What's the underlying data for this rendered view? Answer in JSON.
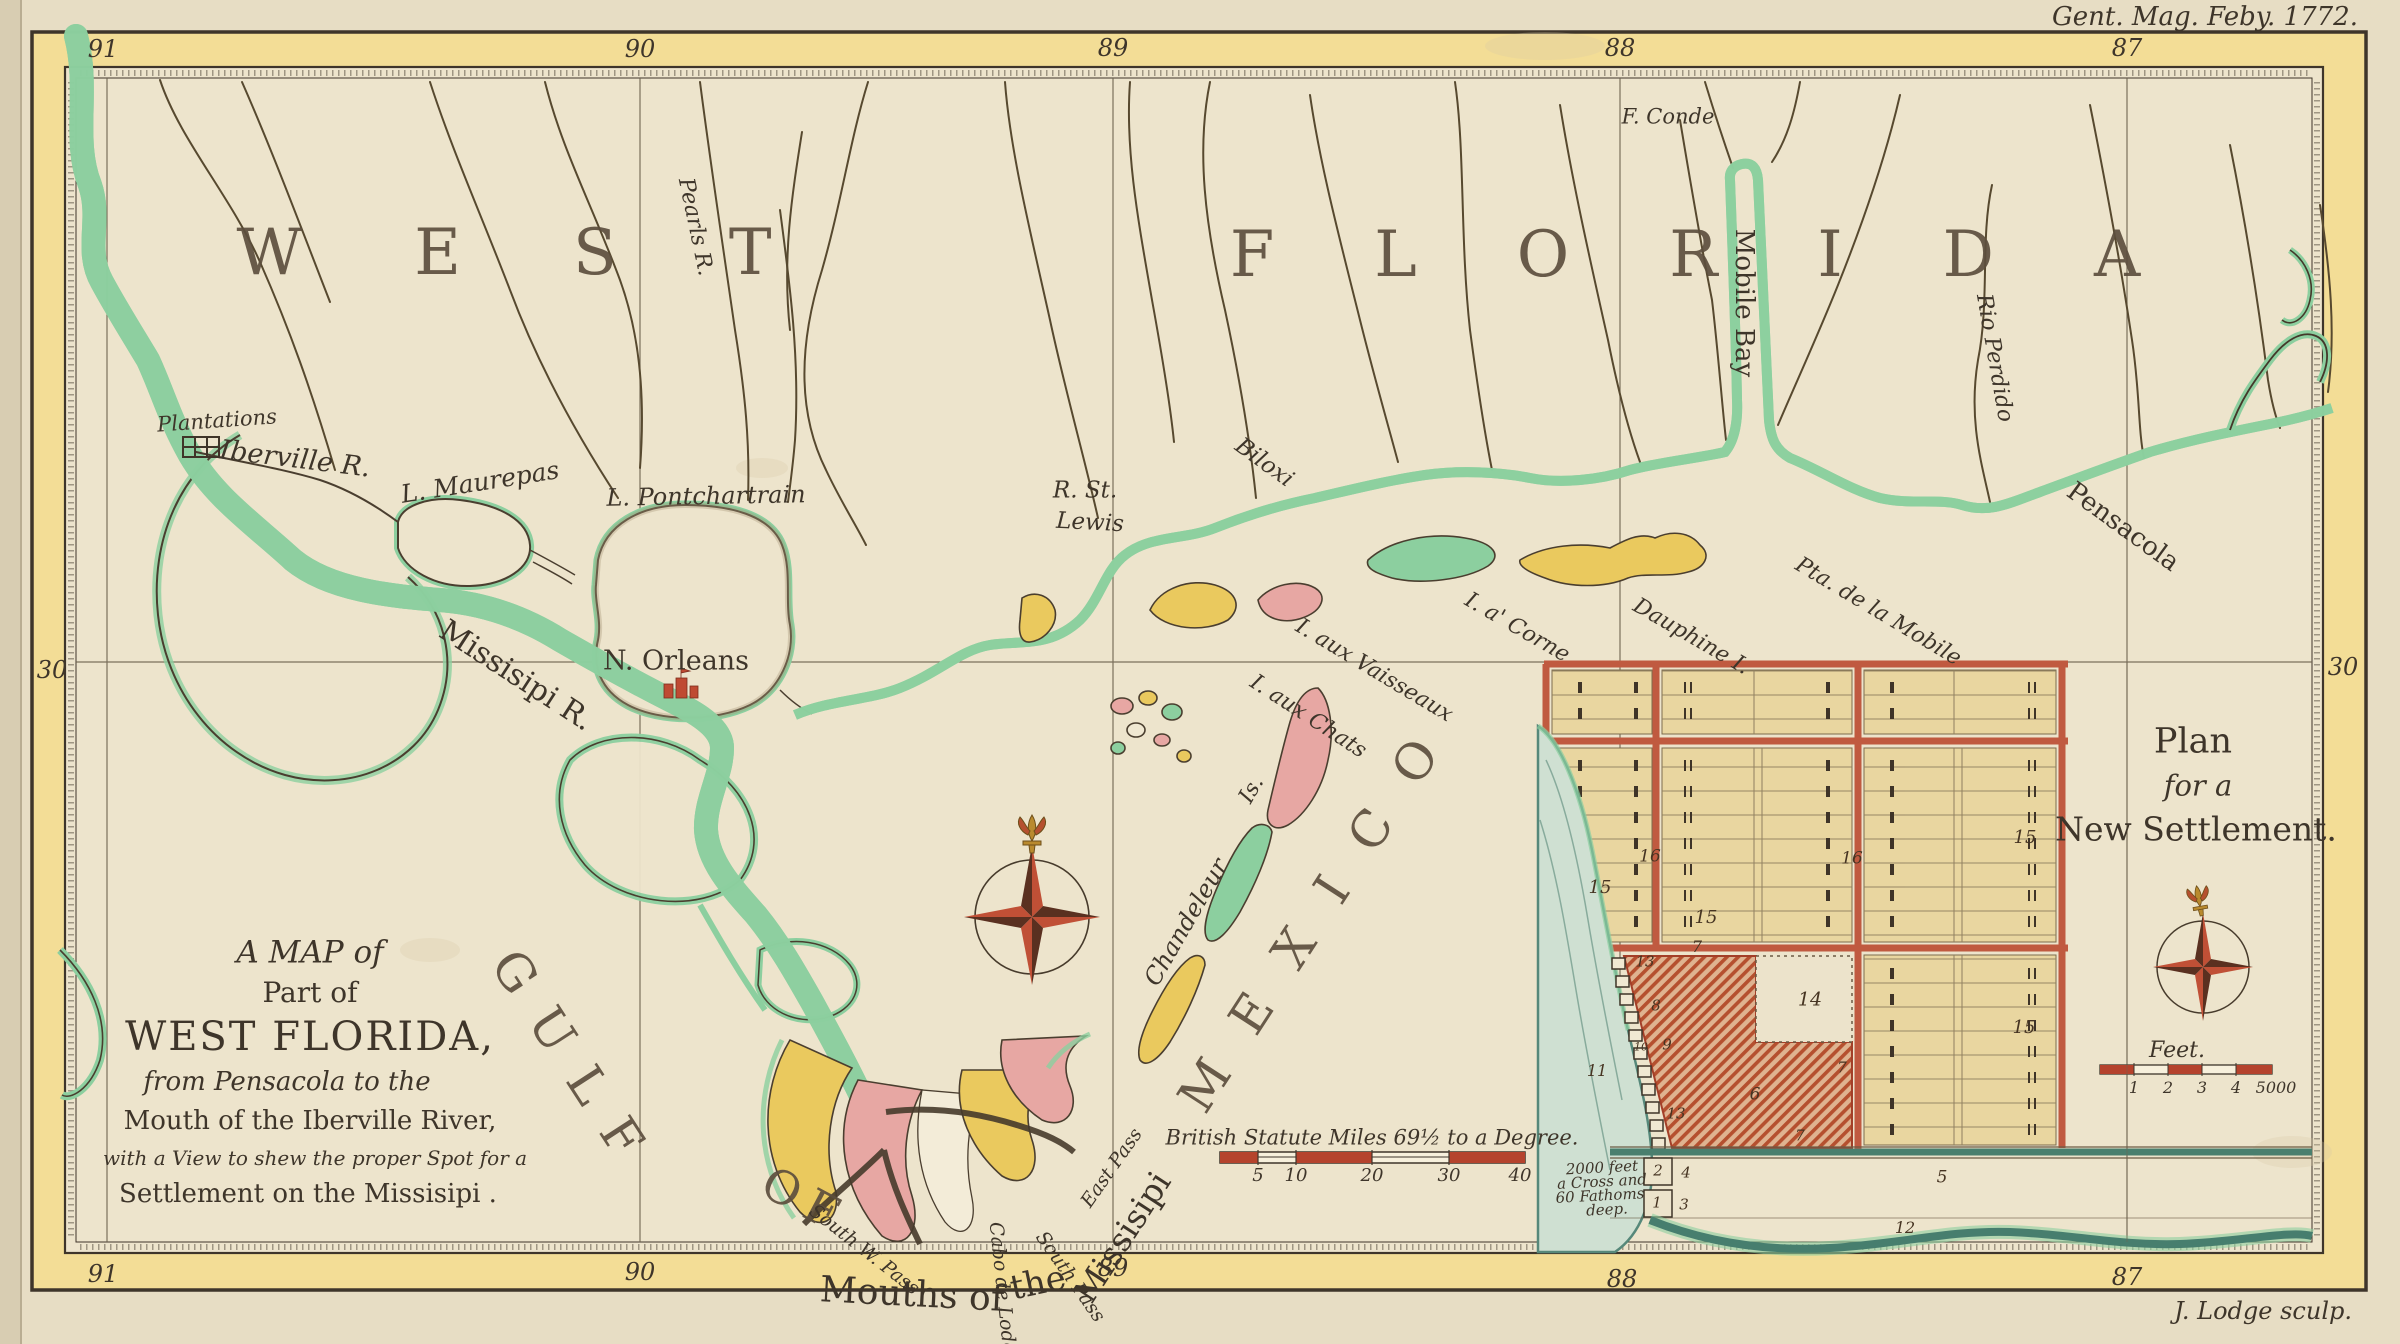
{
  "edition": {
    "publication": "Gent. Mag. Feby. 1772.",
    "engraver": "J. Lodge sculp."
  },
  "frame": {
    "top_degrees": [
      "91",
      "90",
      "89",
      "88",
      "87"
    ],
    "bottom_degrees": [
      "91",
      "90",
      "89",
      "88",
      "87"
    ],
    "left_latitude": "30",
    "right_latitude": "30"
  },
  "title": {
    "l1": "A MAP of",
    "l2": "Part of",
    "l3": "WEST FLORIDA,",
    "l4": "from Pensacola to the",
    "l5": "Mouth of the Iberville River,",
    "l6": "with a View to shew the proper Spot for a",
    "l7": "Settlement on the Missisipi ."
  },
  "regions": {
    "west": "WEST",
    "florida": "FLORIDA",
    "gulf": "GULF",
    "of": "OF",
    "mexico": "MEXICO"
  },
  "places": {
    "plantations": "Plantations",
    "iberville": "Iberville R.",
    "maurepas": "L. Maurepas",
    "pontchartrain": "L. Pontchartrain",
    "pearls": "Pearls R.",
    "missisipi_r": "Missisipi R.",
    "n_orleans": "N. Orleans",
    "r_st": "R. St.",
    "lewis": "Lewis",
    "biloxi": "Biloxi",
    "vaisseaux": "I. aux Vaisseaux",
    "chats": "I. aux Chats",
    "corne": "I. a' Corne",
    "dauphine": "Dauphine I.",
    "pta_mobile": "Pta. de la Mobile",
    "mobile_bay": "Mobile Bay",
    "f_conde": "F. Conde",
    "rio_perdido": "Rio Perdido",
    "pensacola": "Pensacola",
    "chandeleur": "Chandeleur",
    "chandeleur_is": "Is.",
    "mouths": "Mouths of",
    "the": "the",
    "missisipi_mouths": "Missisipi",
    "south_w_pass": "South W. Pass",
    "cabo": "Cabo de Lodo",
    "south_pass": "South Pass",
    "east_pass": "East Pass"
  },
  "scale": {
    "label": "British Statute Miles 69½ to a Degree.",
    "ticks": [
      "5",
      "10",
      "20",
      "30",
      "40"
    ]
  },
  "inset": {
    "title_l1": "Plan",
    "title_l2": "for a",
    "title_l3": "New Settlement.",
    "feet_label": "Feet.",
    "feet_ticks": [
      "1",
      "2",
      "3",
      "4",
      "5000"
    ],
    "depth_l1": "2000 feet",
    "depth_l2": "a Cross and",
    "depth_l3": "60 Fathoms",
    "depth_l4": "deep.",
    "numbers": [
      "15",
      "16",
      "15",
      "7",
      "16",
      "15",
      "15",
      "13",
      "8",
      "9",
      "10",
      "11",
      "13",
      "6",
      "14",
      "7",
      "7",
      "2",
      "1",
      "4",
      "3",
      "5",
      "12"
    ]
  },
  "colors": {
    "border_band": "#f3dd96",
    "coast_green": "#8ccf9f",
    "island_yellow": "#eac95e",
    "island_pink": "#e7a7a3",
    "plan_red": "#c05a40",
    "block_tan": "#e9d6a0",
    "ink": "#3e352a",
    "water_teal": "#4a7f6e"
  }
}
